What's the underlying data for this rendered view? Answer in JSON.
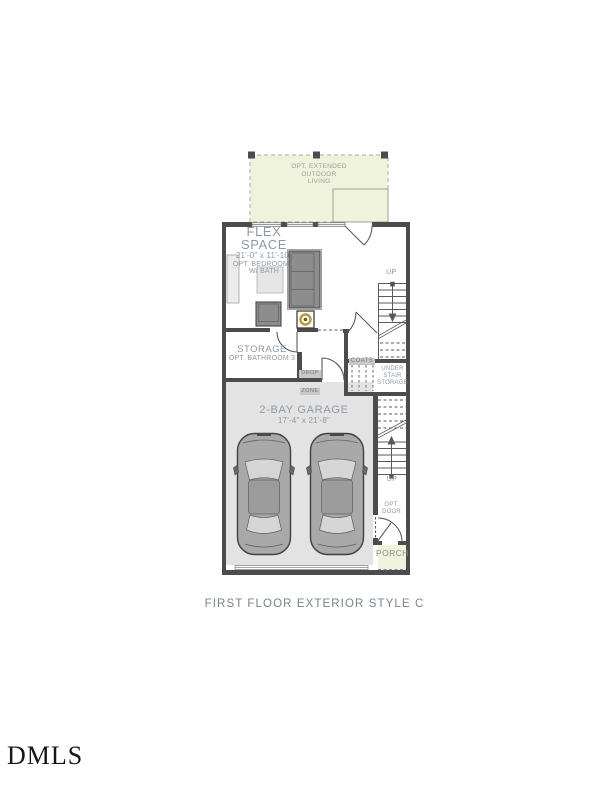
{
  "plan": {
    "outdoor_label": {
      "line1": "OPT. EXTENDED",
      "line2": "OUTDOOR",
      "line3": "LIVING"
    },
    "flex": {
      "name_line1": "FLEX",
      "name_line2": "SPACE",
      "dims": "21'-0\" x 11'-10\"",
      "opt_line1": "OPT. BEDROOM 4",
      "opt_line2": "W/ BATH"
    },
    "storage": {
      "name": "STORAGE",
      "opt": "OPT. BATHROOM 3"
    },
    "garage": {
      "name": "2-BAY GARAGE",
      "dims": "17'-4\" x 21'-8\""
    },
    "coats_label": "COATS",
    "drop_zone": {
      "line1": "DROP",
      "line2": "ZONE"
    },
    "under_stair": {
      "line1": "UNDER",
      "line2": "STAIR",
      "line3": "STORAGE"
    },
    "stairs_up_top": "UP",
    "stairs_up_bottom": "UP",
    "opt_door": {
      "line1": "OPT.",
      "line2": "DOOR"
    },
    "porch_label": "PORCH"
  },
  "caption": "FIRST FLOOR EXTERIOR STYLE C",
  "watermark": "DMLS",
  "colors": {
    "wall": "#4c4c4c",
    "outdoor_fill": "#eff3dc",
    "garage_floor": "#e3e3e3",
    "label_text": "#8d9aa6",
    "accent_gold": "#bd9634",
    "caption_text": "#75848e"
  }
}
